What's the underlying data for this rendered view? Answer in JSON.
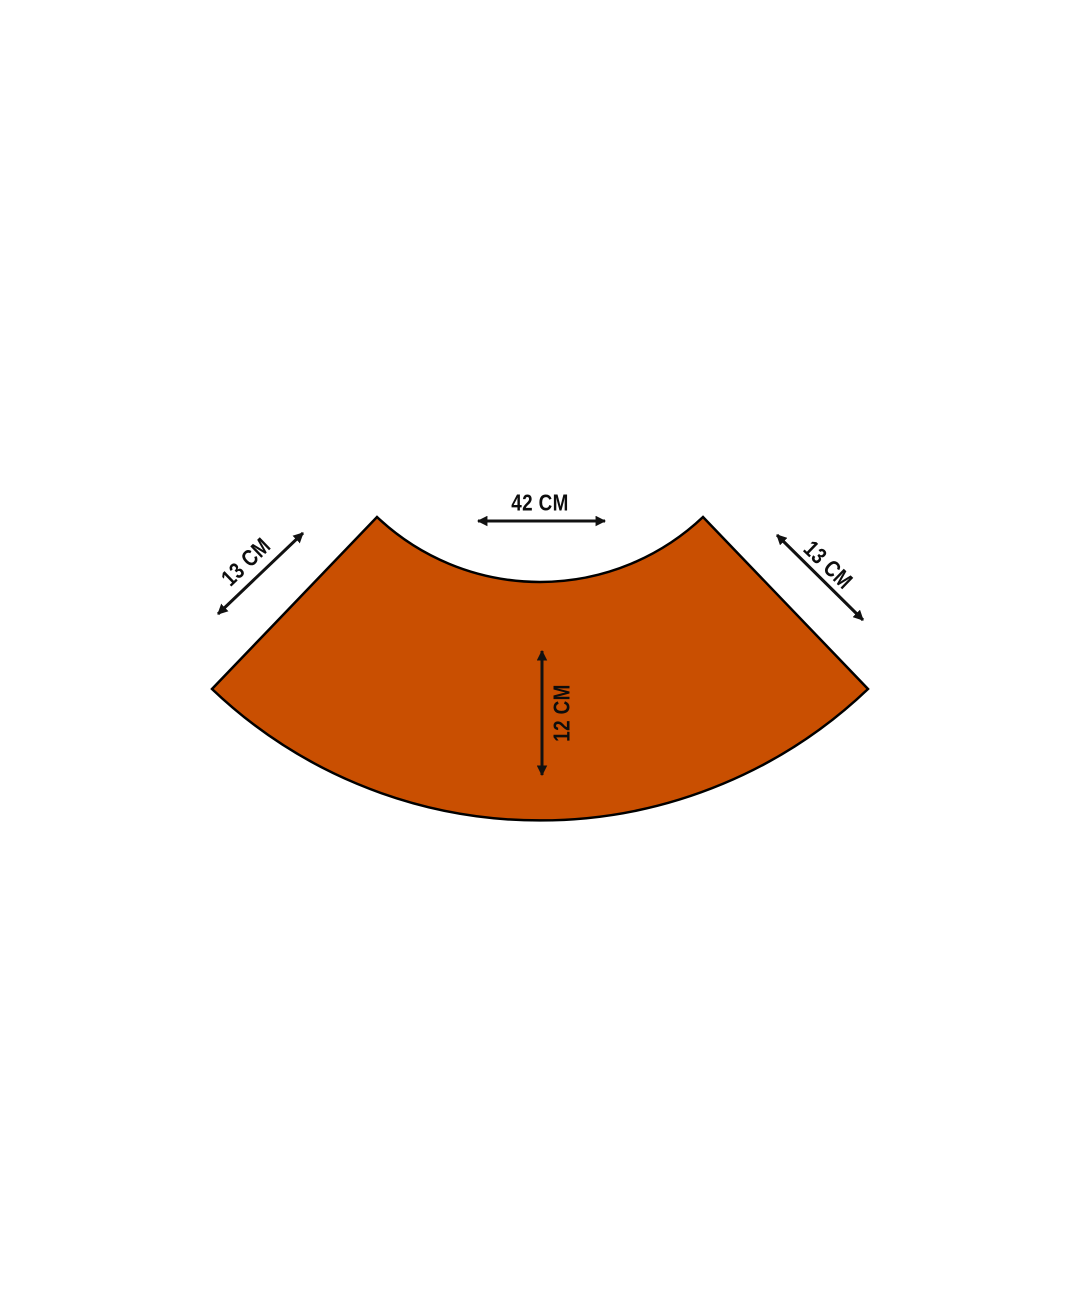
{
  "colors": {
    "background": "#FFFFFF",
    "shape_fill": "#C94F01",
    "shape_outline": "#000000",
    "dimension_color": "#111111"
  },
  "dimensions": {
    "top_width": "42 CM",
    "left_edge": "13 CM",
    "right_edge": "13 CM",
    "band_height": "12 CM"
  }
}
